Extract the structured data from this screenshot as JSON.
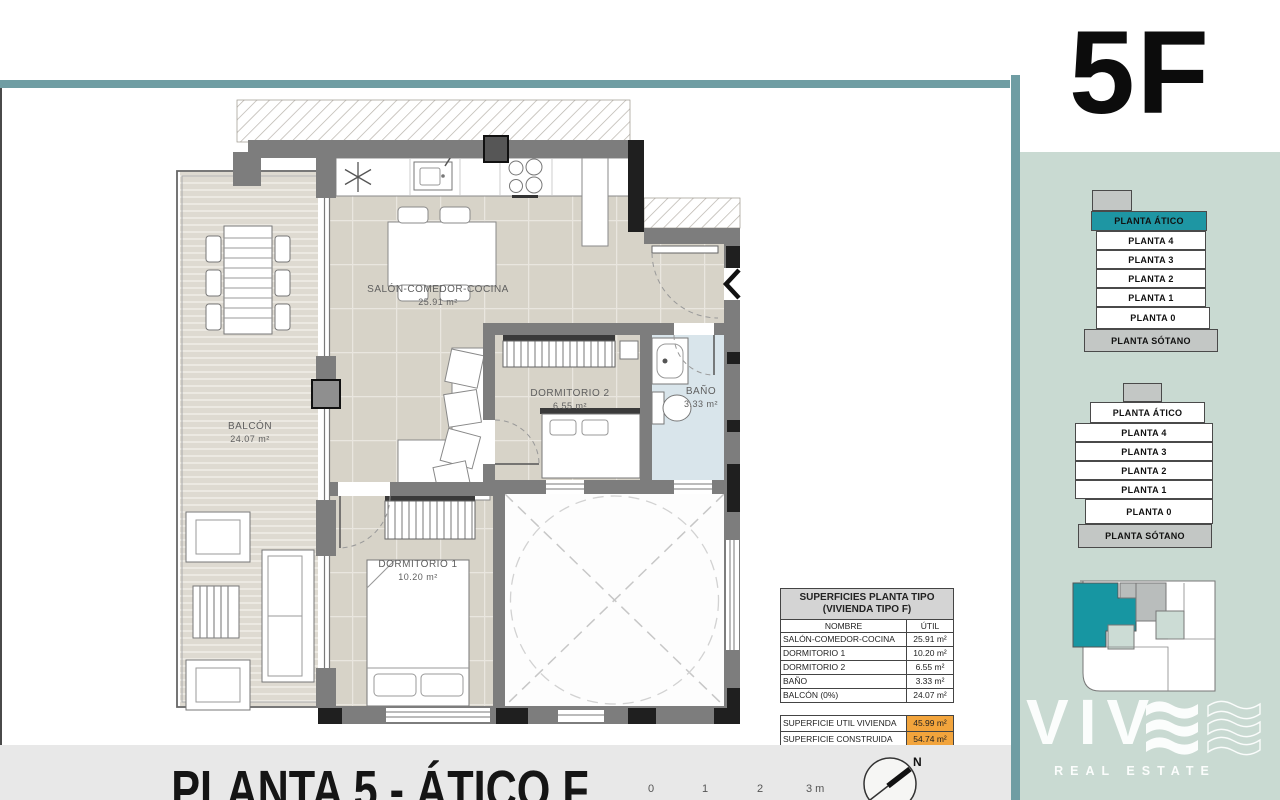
{
  "unit_code": "5F",
  "sheet": {
    "title": "PLANTA 5 - ÁTICO F",
    "scale_labels": [
      "0",
      "1",
      "2",
      "3 m"
    ],
    "north_label": "N"
  },
  "plan": {
    "rooms": [
      {
        "name": "SALÓN-COMEDOR-COCINA",
        "area": "25.91 m²"
      },
      {
        "name": "DORMITORIO 2",
        "area": "6.55 m²"
      },
      {
        "name": "BAÑO",
        "area": "3.33 m²"
      },
      {
        "name": "BALCÓN",
        "area": "24.07 m²"
      },
      {
        "name": "DORMITORIO 1",
        "area": "10.20 m²"
      }
    ]
  },
  "surfaces_table": {
    "title_line1": "SUPERFICIES PLANTA TIPO",
    "title_line2": "(VIVIENDA TIPO F)",
    "col_name": "NOMBRE",
    "col_util": "ÚTIL",
    "rows": [
      {
        "name": "SALÓN-COMEDOR-COCINA",
        "util": "25.91 m²"
      },
      {
        "name": "DORMITORIO 1",
        "util": "10.20 m²"
      },
      {
        "name": "DORMITORIO 2",
        "util": "6.55 m²"
      },
      {
        "name": "BAÑO",
        "util": "3.33 m²"
      },
      {
        "name": "BALCÓN (0%)",
        "util": "24.07 m²"
      }
    ],
    "totals": [
      {
        "name": "SUPERFICIE UTIL VIVIENDA",
        "value": "45.99 m²"
      },
      {
        "name": "SUPERFICIE CONSTRUIDA",
        "value": "54.74 m²"
      }
    ]
  },
  "floor_stacks": [
    {
      "selected": "PLANTA ÁTICO",
      "floors": [
        "PLANTA ÁTICO",
        "PLANTA 4",
        "PLANTA 3",
        "PLANTA 2",
        "PLANTA 1",
        "PLANTA 0",
        "PLANTA SÓTANO"
      ]
    },
    {
      "selected": "",
      "floors": [
        "PLANTA ÁTICO",
        "PLANTA 4",
        "PLANTA 3",
        "PLANTA 2",
        "PLANTA 1",
        "PLANTA 0",
        "PLANTA SÓTANO"
      ]
    }
  ],
  "logo": {
    "brand": "VIV",
    "tagline": "REAL ESTATE"
  },
  "colors": {
    "accent_teal": "#1e96a3",
    "frame_teal": "#6f9da3",
    "sidebar_green": "#c9dad2",
    "highlight_orange": "#f2a43c",
    "wall_gray": "#7d7d7d",
    "bath_blue": "#d9e5eb",
    "floor_beige": "#d7d3c8"
  }
}
